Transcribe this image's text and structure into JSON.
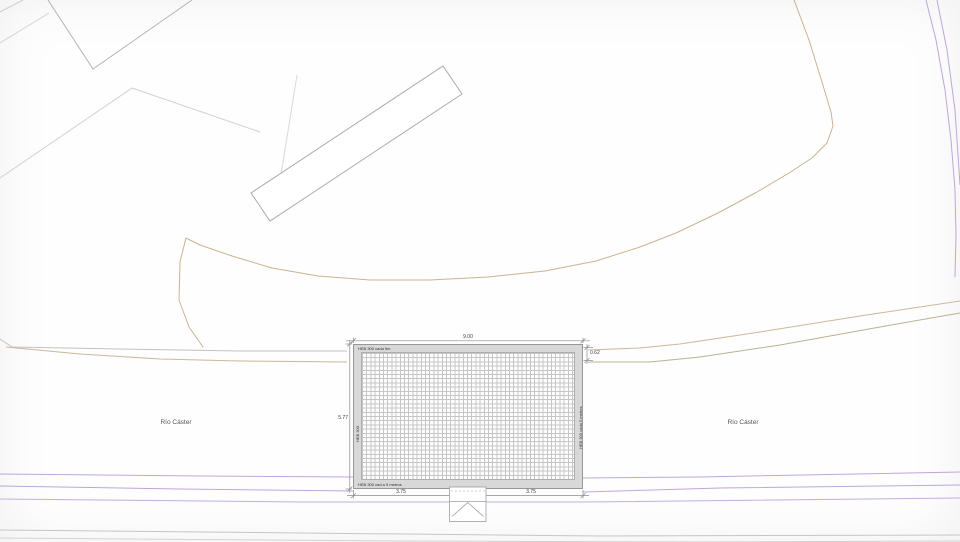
{
  "drawing": {
    "river_label_left": "Río Cáster",
    "river_label_right": "Río Cáster",
    "deck": {
      "note_top": "HEB 300 cada 5m",
      "note_bottom": "HEB 300 cad a 5 metros",
      "note_left": "HEB 300",
      "note_right": "HEB 300 cada 5 metros"
    },
    "dimensions": {
      "top_width": "9.00",
      "left_height": "5.77",
      "right_offset": "0.62",
      "bottom_left_span": "3.75",
      "bottom_right_span": "3.75"
    },
    "colors": {
      "parcel_line": "#b4b4b4",
      "terrain_line": "#c9b393",
      "olive_line": "#b9b295",
      "road_line": "#bda6da",
      "bank_line_gray": "#c2c2c2",
      "deck_fill": "#d8d8d8",
      "deck_grid": "#c6c6c6",
      "dimension_line": "#8c8c8c",
      "text": "#3a3a3a"
    }
  }
}
